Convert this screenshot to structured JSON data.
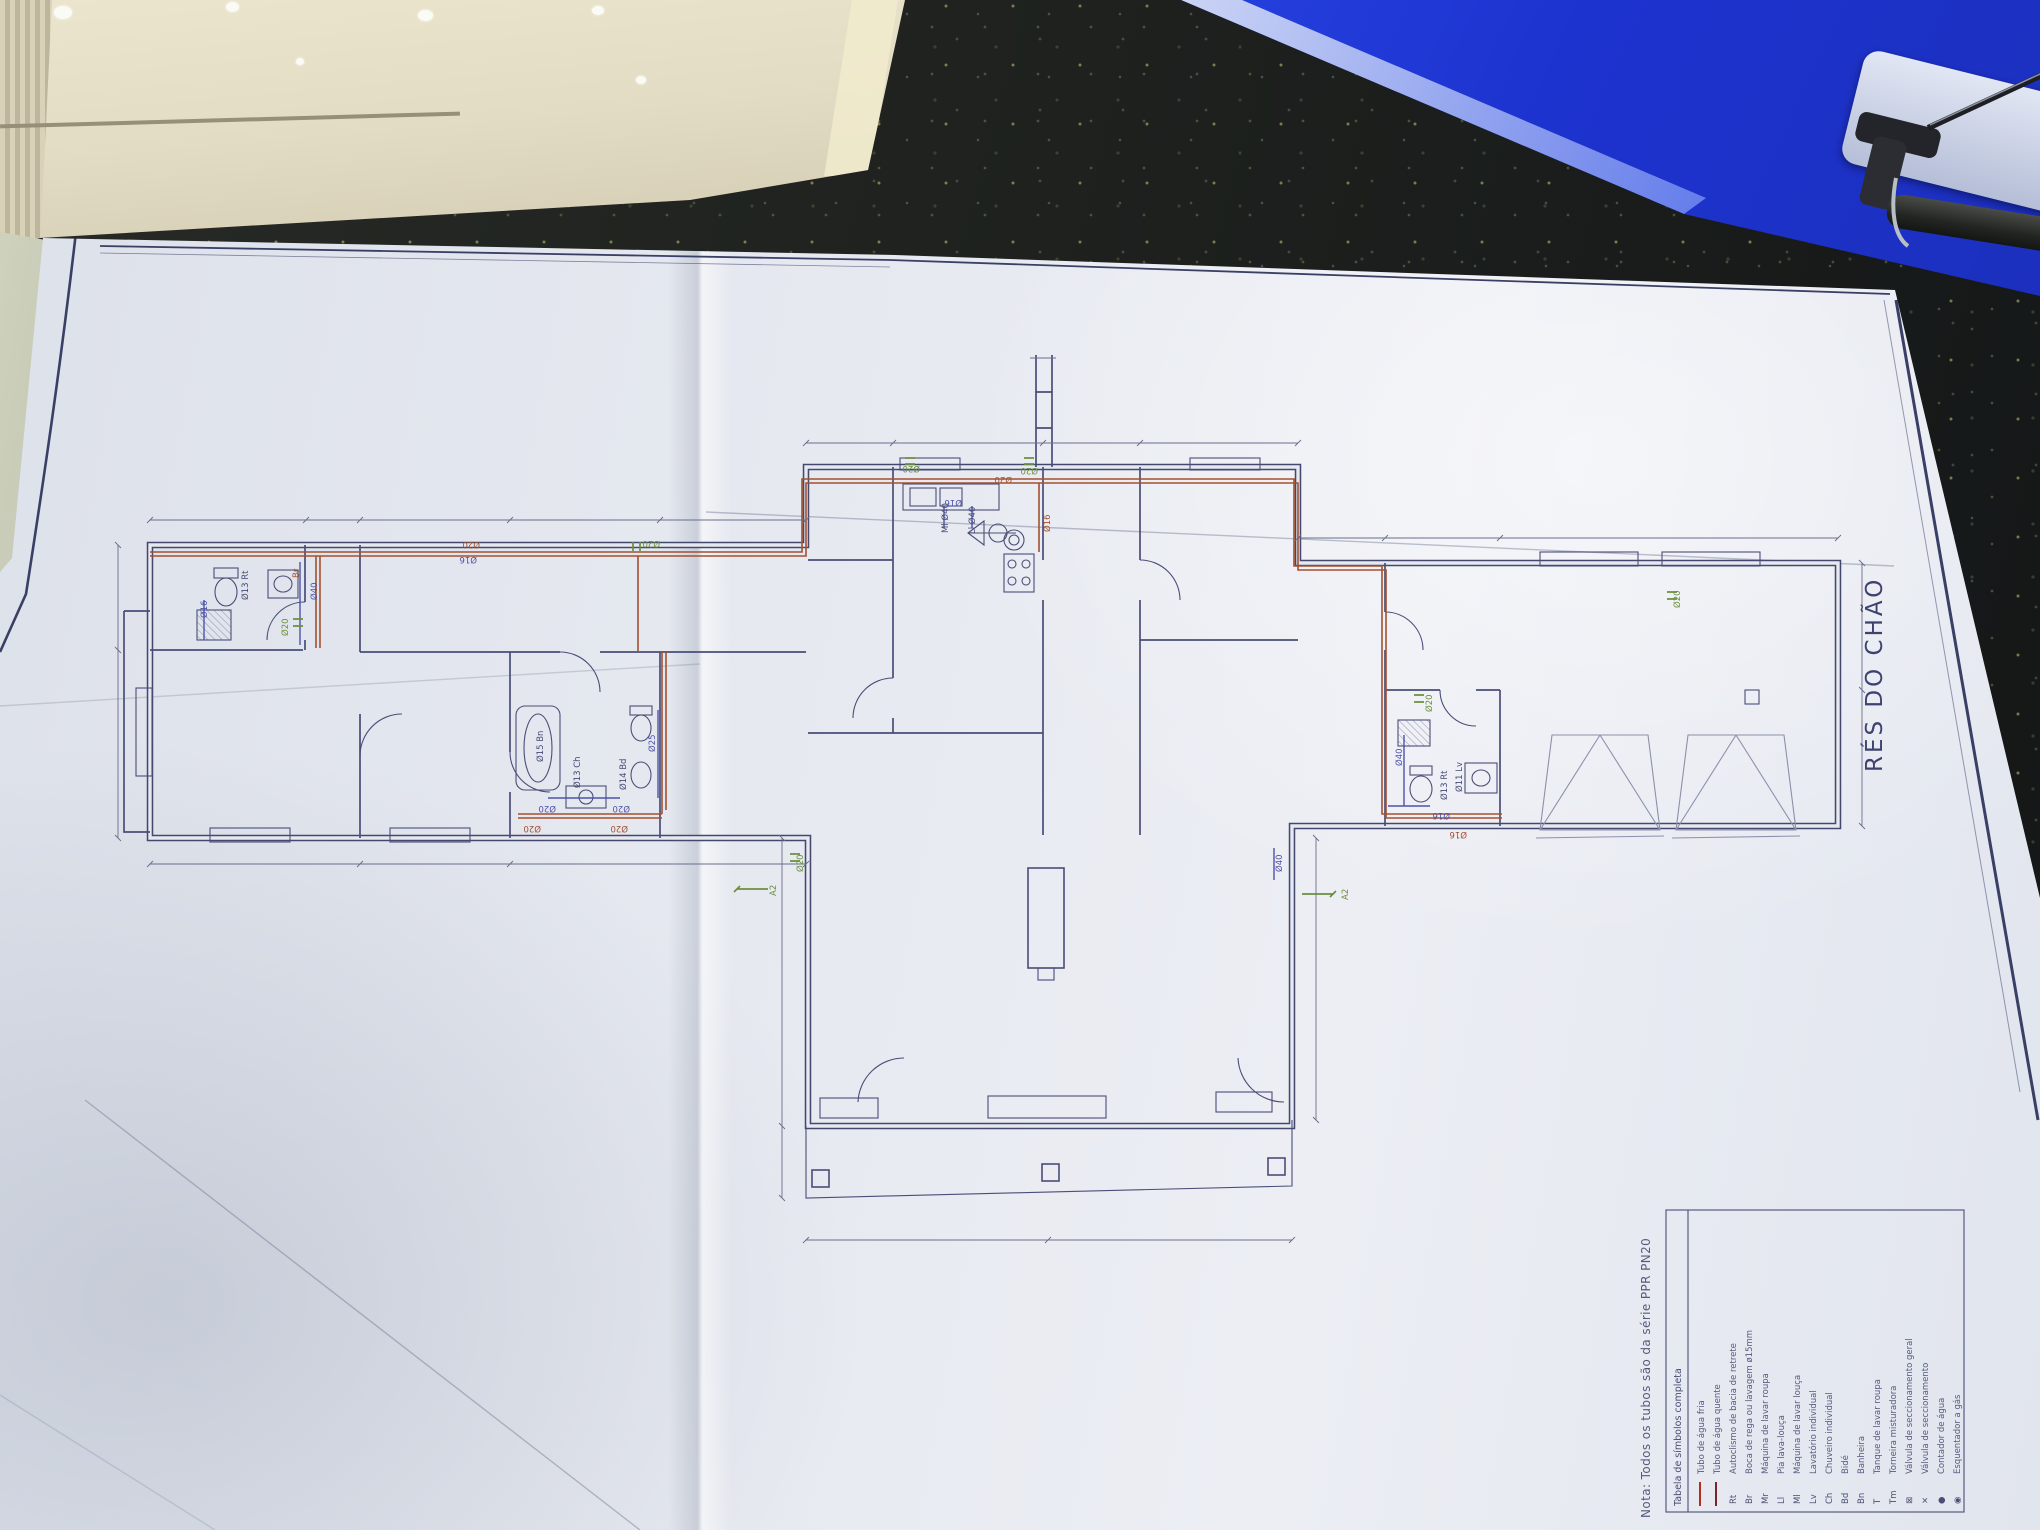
{
  "colors": {
    "paper": "#e6e9f0",
    "plan_line_navy": "#44486e",
    "pipe_red": "#a3502f",
    "label_green": "#6b8f3f",
    "label_blue": "#4f52a8",
    "folder_blue": "#1d33cf",
    "cardboard": "#e3dcc4",
    "countertop": "#1c1f1d"
  },
  "sheet": {
    "floor_title": "RÉS DO CHÃO",
    "note": "Nota: Todos os tubos são da série PPR PN20"
  },
  "legend": {
    "header": "Tabela de símbolos completa",
    "rows": [
      {
        "symbol": "",
        "label": "Tubo de água fria"
      },
      {
        "symbol": "",
        "label": "Tubo de água quente"
      },
      {
        "symbol": "Rt",
        "label": "Autoclismo de bacia de retrete"
      },
      {
        "symbol": "Br",
        "label": "Boca de rega ou lavagem ø15mm"
      },
      {
        "symbol": "Mr",
        "label": "Máquina de lavar roupa"
      },
      {
        "symbol": "Ll",
        "label": "Pia lava-louça"
      },
      {
        "symbol": "Ml",
        "label": "Máquina de lavar louça"
      },
      {
        "symbol": "Lv",
        "label": "Lavatório individual"
      },
      {
        "symbol": "Ch",
        "label": "Chuveiro individual"
      },
      {
        "symbol": "Bd",
        "label": "Bidé"
      },
      {
        "symbol": "Bn",
        "label": "Banheira"
      },
      {
        "symbol": "T",
        "label": "Tanque de lavar roupa"
      },
      {
        "symbol": "Tm",
        "label": "Torneira misturadora"
      },
      {
        "symbol": "⊠",
        "label": "Válvula de seccionamento geral"
      },
      {
        "symbol": "✕",
        "label": "Válvula de seccionamento"
      },
      {
        "symbol": "●",
        "label": "Contador de água"
      },
      {
        "symbol": "◉",
        "label": "Esquentador a gás"
      }
    ]
  },
  "plan": {
    "labels": [
      {
        "text": "Ø20"
      },
      {
        "text": "Ø16"
      },
      {
        "text": "Ø20"
      },
      {
        "text": "Br"
      },
      {
        "text": "Ø16"
      },
      {
        "text": "Ø13 Rt"
      },
      {
        "text": "Ø40"
      },
      {
        "text": "Ø20"
      },
      {
        "text": "Ø15 Bn"
      },
      {
        "text": "Ø13 Ch"
      },
      {
        "text": "Ø14 Bd"
      },
      {
        "text": "Ø25"
      },
      {
        "text": "Ø20"
      },
      {
        "text": "Ø20"
      },
      {
        "text": "Ø20"
      },
      {
        "text": "Ø20"
      },
      {
        "text": "Ml Ø40"
      },
      {
        "text": "Ll Ø40"
      },
      {
        "text": "Ø16"
      },
      {
        "text": "Ø20"
      },
      {
        "text": "Ø16"
      },
      {
        "text": "A2"
      },
      {
        "text": "A2"
      },
      {
        "text": "Ø40"
      },
      {
        "text": "Ø20"
      },
      {
        "text": "Ø16"
      },
      {
        "text": "Ø16"
      },
      {
        "text": "Ø40"
      },
      {
        "text": "Ø20"
      },
      {
        "text": "Ø13 Rt"
      },
      {
        "text": "Ø11 Lv"
      },
      {
        "text": "Ø20"
      },
      {
        "text": "Ø20"
      },
      {
        "text": "Ø20"
      }
    ]
  }
}
